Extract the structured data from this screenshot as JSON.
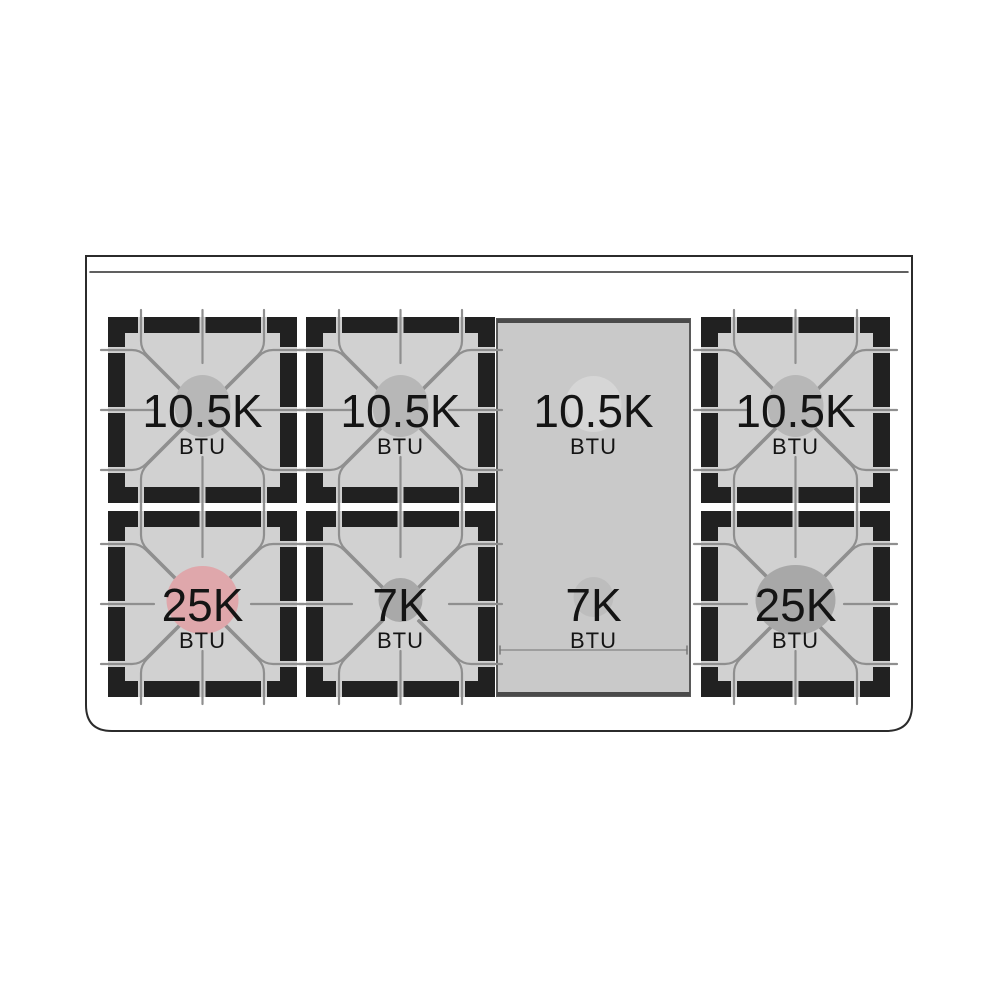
{
  "diagram": {
    "name": "gas-range-cooktop-burner-btu-layout",
    "unit_label": "BTU",
    "colors": {
      "background": "#ffffff",
      "outline": "#2b2b2b",
      "frame_black": "#212121",
      "burner_fill": "#d1d1d1",
      "griddle_fill": "#c9c9c9",
      "griddle_border": "#4a4a4a",
      "grate_line": "#8f8f8f",
      "label_text": "#141414",
      "accent_pink": "#dfa7ab"
    },
    "burners": [
      {
        "id": "back-left",
        "label": "10.5K",
        "unit": "BTU",
        "row": 1,
        "col": 1,
        "kind": "grate",
        "circle": {
          "color": "#b7b7b7",
          "rx": 28,
          "ry": 31
        }
      },
      {
        "id": "back-center-left",
        "label": "10.5K",
        "unit": "BTU",
        "row": 1,
        "col": 2,
        "kind": "grate",
        "circle": {
          "color": "#b7b7b7",
          "rx": 28,
          "ry": 31
        }
      },
      {
        "id": "griddle-back",
        "label": "10.5K",
        "unit": "BTU",
        "row": 1,
        "col": 3,
        "kind": "griddle-top",
        "circle": {
          "color": "#d6d6d6",
          "rx": 28,
          "ry": 28
        }
      },
      {
        "id": "back-right",
        "label": "10.5K",
        "unit": "BTU",
        "row": 1,
        "col": 4,
        "kind": "grate",
        "circle": {
          "color": "#b7b7b7",
          "rx": 28,
          "ry": 31
        }
      },
      {
        "id": "front-left",
        "label": "25K",
        "unit": "BTU",
        "row": 2,
        "col": 1,
        "kind": "grate",
        "circle": {
          "color": "#dfa7ab",
          "rx": 36,
          "ry": 34
        }
      },
      {
        "id": "front-center-left",
        "label": "7K",
        "unit": "BTU",
        "row": 2,
        "col": 2,
        "kind": "grate",
        "circle": {
          "color": "#a9a9a9",
          "rx": 22,
          "ry": 22
        }
      },
      {
        "id": "griddle-front",
        "label": "7K",
        "unit": "BTU",
        "row": 2,
        "col": 3,
        "kind": "griddle-bottom",
        "circle": {
          "color": "#bdbdbd",
          "rx": 20,
          "ry": 20
        }
      },
      {
        "id": "front-right",
        "label": "25K",
        "unit": "BTU",
        "row": 2,
        "col": 4,
        "kind": "grate",
        "circle": {
          "color": "#a8a8a8",
          "rx": 40,
          "ry": 35
        }
      }
    ]
  }
}
